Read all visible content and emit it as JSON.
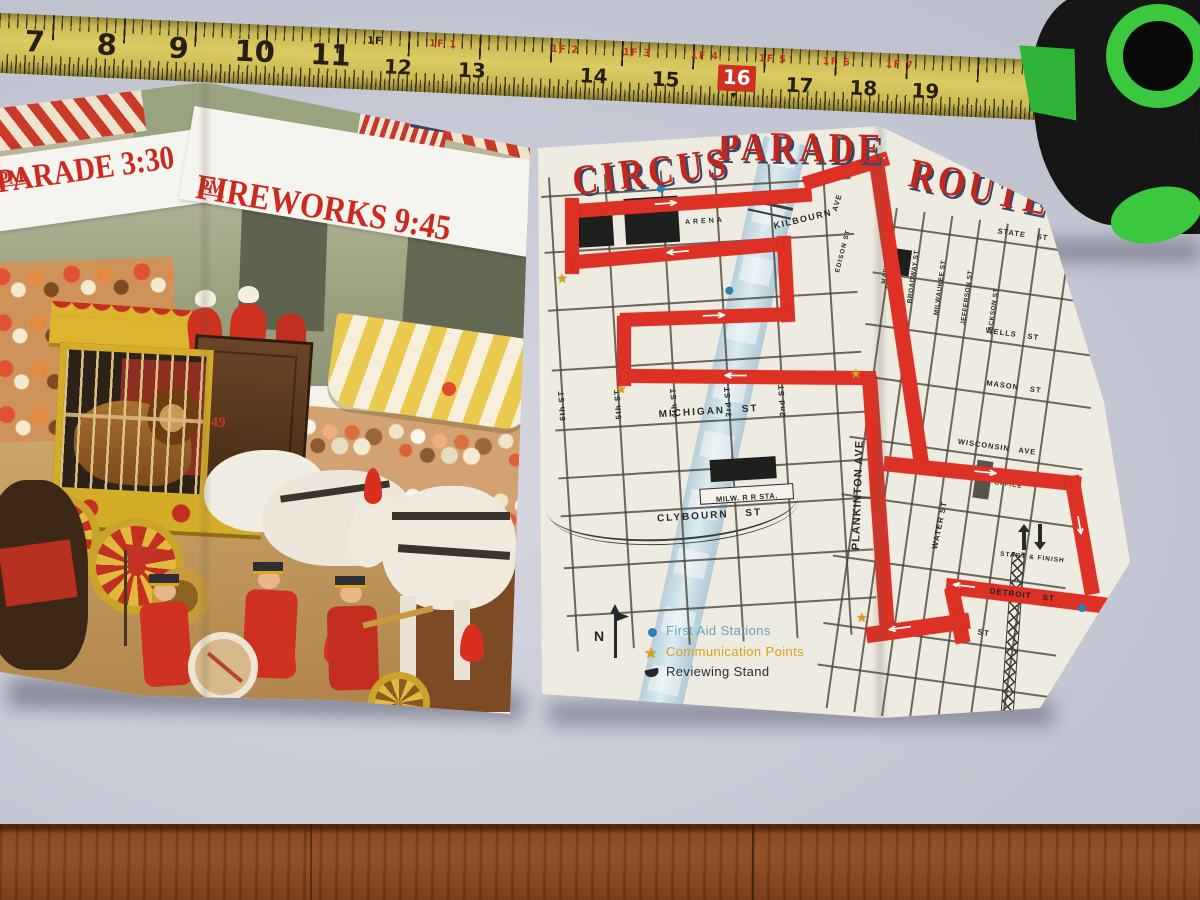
{
  "tape": {
    "numbers": [
      "7",
      "8",
      "9",
      "10",
      "11",
      "12",
      "13",
      "14",
      "15",
      "16",
      "17",
      "18",
      "19"
    ],
    "foot_labels": [
      "1F 1",
      "1F 2",
      "1F 3",
      "1F 4",
      "1F 5",
      "1F 6",
      "1F 7"
    ],
    "black_foot_label": "1F",
    "highlight_number": "16"
  },
  "left_panel": {
    "banner": {
      "parade": "PARADE 3:30",
      "parade_suffix": "PM",
      "fireworks": "FIREWORKS 9:45",
      "fireworks_suffix": "PM"
    },
    "wagon_number": "49"
  },
  "right_panel": {
    "title_words": [
      "CIRCUS",
      "PARADE",
      "ROUTE"
    ],
    "map": {
      "west_streets": {
        "s6": "6th ST",
        "s5": "5th ST",
        "s4": "4th ST",
        "s3": "3rd ST",
        "s2": "2nd ST",
        "michigan": "MICHIGAN ST",
        "clybourn": "CLYBOURN ST",
        "kilbourn": "KILBOURN",
        "kilbourn_ave": "AVE",
        "edison": "EDISON ST",
        "plankinton": "PLANKINTON AVE"
      },
      "east_streets": {
        "state": "STATE ST",
        "wells": "WELLS ST",
        "mason": "MASON ST",
        "wisconsin": "WISCONSIN AVE",
        "detroit": "DETROIT ST",
        "buffalo": "BUFFALO ST",
        "market": "MARKET ST",
        "broadway": "BROADWAY ST",
        "milwaukee": "MILWAUKEE ST",
        "jefferson": "JEFFERSON ST",
        "jackson": "JACKSON ST",
        "water": "WATER ST"
      },
      "buildings": {
        "auditorium_line1": "AUDITORIUM",
        "auditorium_line2": "ARENA",
        "station": "MILW. R R STA.",
        "city_hall_line1": "CITY",
        "city_hall_line2": "HALL",
        "post_office_line1": "POST",
        "post_office_line2": "OFFICE"
      },
      "start_finish": "START & FINISH",
      "north": "N",
      "legend": [
        {
          "label": "First Aid Stations",
          "color": "#68a0bf"
        },
        {
          "label": "Communication Points",
          "color": "#d9a020"
        },
        {
          "label": "Reviewing Stand",
          "color": "#2c2c34"
        }
      ],
      "route_color": "#de3126",
      "river_color": "#bdd4de"
    }
  },
  "icons": {
    "arrow_right": "→",
    "arrow_left": "←",
    "arrow_down": "↓",
    "star": "★"
  }
}
